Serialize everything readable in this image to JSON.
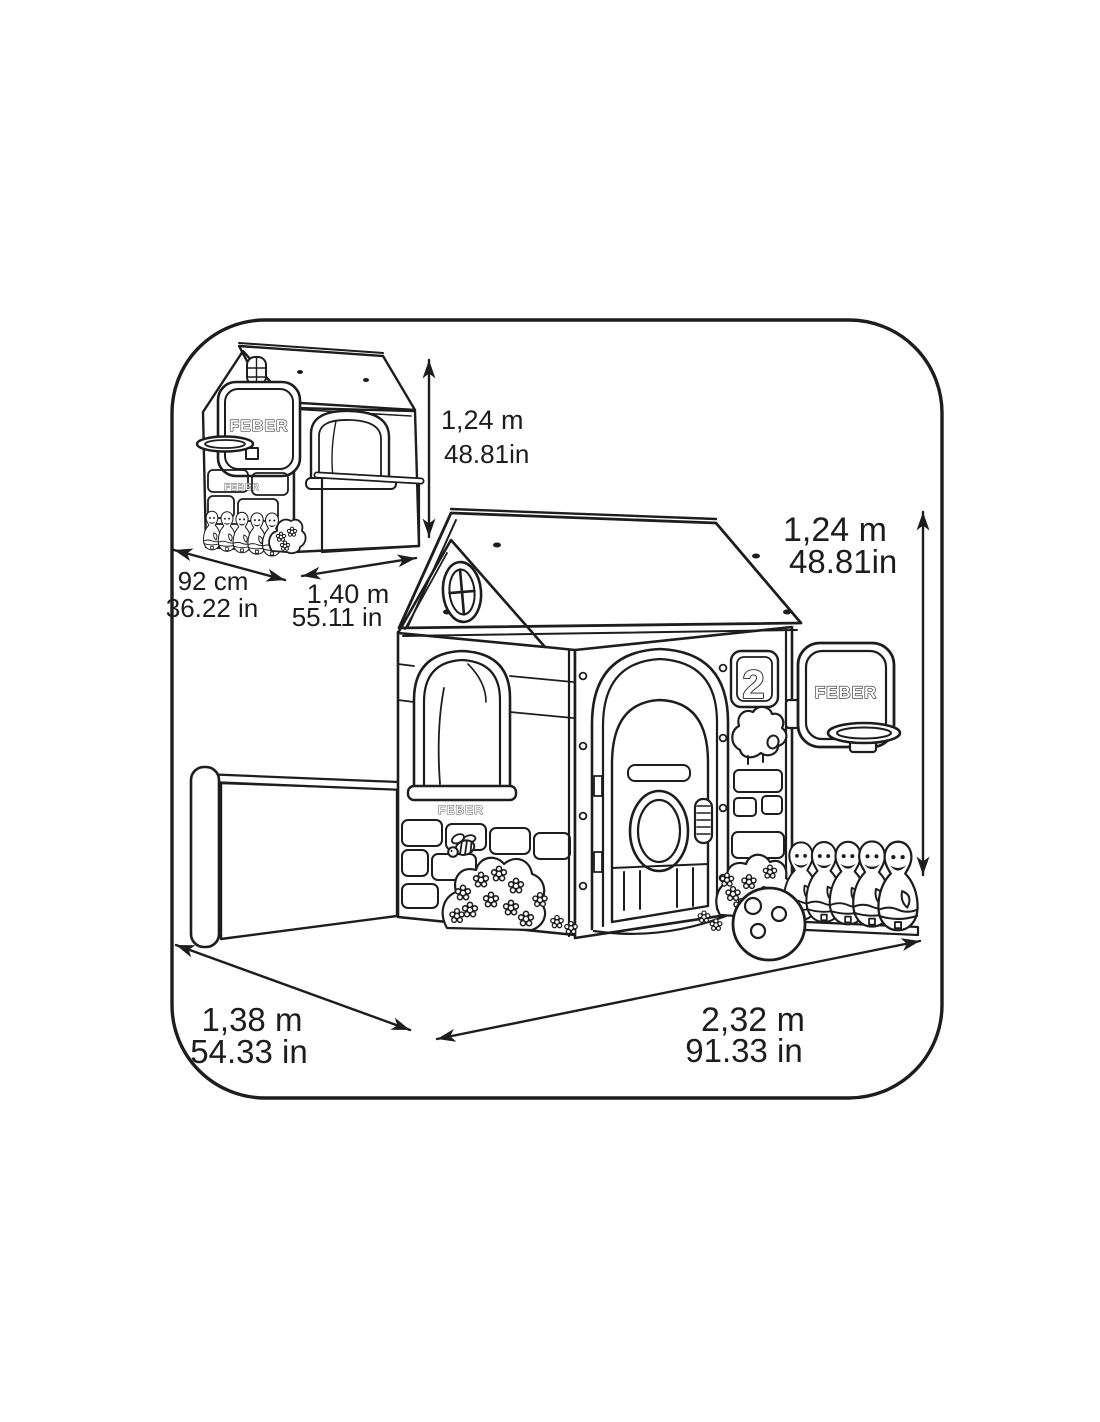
{
  "page": {
    "background_color": "#ffffff",
    "line_color": "#1d1d1d"
  },
  "diagram": {
    "brand_logo": "FEBER",
    "house_number_plate": "2",
    "inset_house": {
      "height_metric": "1,24 m",
      "height_imperial": "48.81in",
      "depth_metric": "92 cm",
      "depth_imperial": "36.22 in",
      "width_metric": "1,40 m",
      "width_imperial": "55.11 in"
    },
    "main_house": {
      "height_metric": "1,24 m",
      "height_imperial": "48.81in",
      "depth_metric": "1,38 m",
      "depth_imperial": "54.33 in",
      "width_metric": "2,32 m",
      "width_imperial": "91.33 in"
    }
  }
}
